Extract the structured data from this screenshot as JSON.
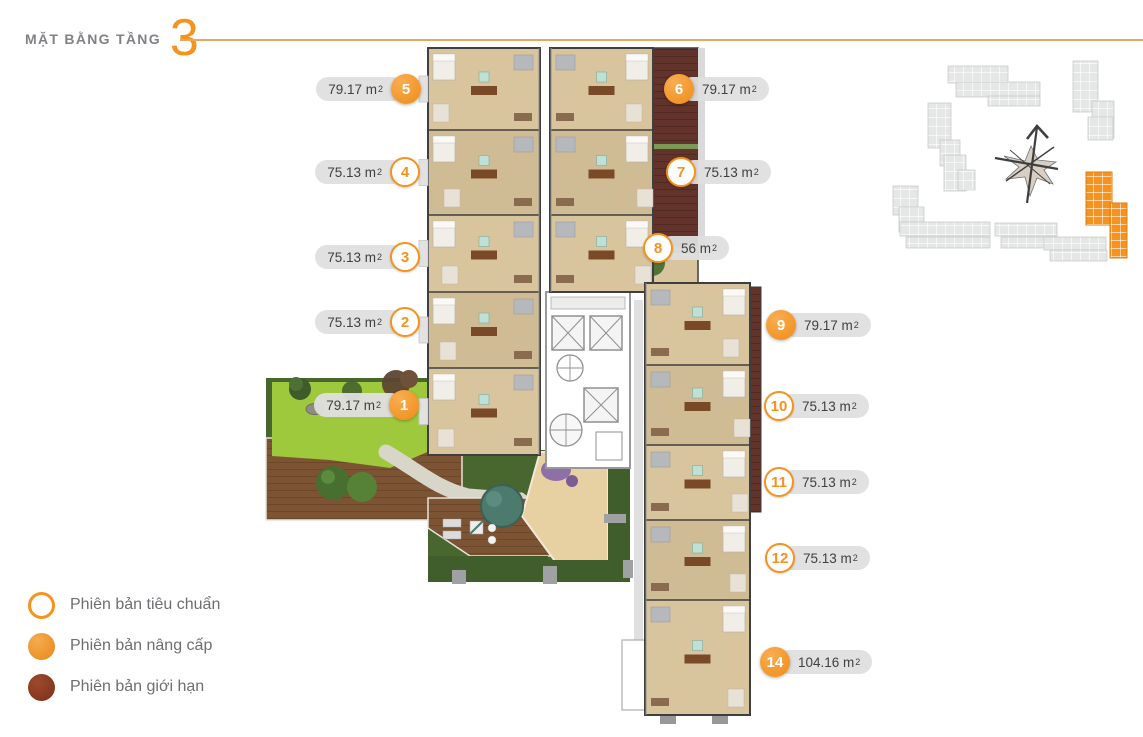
{
  "header": {
    "title": "MẶT BẰNG TẦNG",
    "floor_number": "3"
  },
  "colors": {
    "accent_orange": "#F6921E",
    "title_gray": "#808285",
    "rule_orange": "#EDA45C",
    "pill_background": "#DFDFDF",
    "pill_text": "#414042",
    "legend_standard_outline": "#F6921E",
    "legend_upgraded_fill": "#EF9021",
    "legend_limited_fill": "#8E3B24"
  },
  "units": [
    {
      "no": "1",
      "area": "79.17",
      "unit": "m",
      "sup": "2",
      "variant": "upgraded",
      "side": "left",
      "x": 404,
      "y": 405
    },
    {
      "no": "2",
      "area": "75.13",
      "unit": "m",
      "sup": "2",
      "variant": "standard",
      "side": "left",
      "x": 405,
      "y": 322
    },
    {
      "no": "3",
      "area": "75.13",
      "unit": "m",
      "sup": "2",
      "variant": "standard",
      "side": "left",
      "x": 405,
      "y": 257
    },
    {
      "no": "4",
      "area": "75.13",
      "unit": "m",
      "sup": "2",
      "variant": "standard",
      "side": "left",
      "x": 405,
      "y": 172
    },
    {
      "no": "5",
      "area": "79.17",
      "unit": "m",
      "sup": "2",
      "variant": "upgraded",
      "side": "left",
      "x": 406,
      "y": 89
    },
    {
      "no": "6",
      "area": "79.17",
      "unit": "m",
      "sup": "2",
      "variant": "upgraded",
      "side": "right",
      "x": 679,
      "y": 89
    },
    {
      "no": "7",
      "area": "75.13",
      "unit": "m",
      "sup": "2",
      "variant": "standard",
      "side": "right",
      "x": 681,
      "y": 172
    },
    {
      "no": "8",
      "area": "56",
      "unit": "m",
      "sup": "2",
      "variant": "standard",
      "side": "right",
      "x": 658,
      "y": 248
    },
    {
      "no": "9",
      "area": "79.17",
      "unit": "m",
      "sup": "2",
      "variant": "upgraded",
      "side": "right",
      "x": 781,
      "y": 325
    },
    {
      "no": "10",
      "area": "75.13",
      "unit": "m",
      "sup": "2",
      "variant": "standard",
      "side": "right",
      "x": 779,
      "y": 406
    },
    {
      "no": "11",
      "area": "75.13",
      "unit": "m",
      "sup": "2",
      "variant": "standard",
      "side": "right",
      "x": 779,
      "y": 482
    },
    {
      "no": "12",
      "area": "75.13",
      "unit": "m",
      "sup": "2",
      "variant": "standard",
      "side": "right",
      "x": 780,
      "y": 558
    },
    {
      "no": "14",
      "area": "104.16",
      "unit": "m",
      "sup": "2",
      "variant": "upgraded",
      "side": "right",
      "x": 775,
      "y": 662
    }
  ],
  "legend": {
    "items": [
      {
        "id": "standard",
        "label": "Phiên bản tiêu chuẩn"
      },
      {
        "id": "upgraded",
        "label": "Phiên bản nâng cấp"
      },
      {
        "id": "limited",
        "label": "Phiên bản giới hạn"
      }
    ]
  }
}
